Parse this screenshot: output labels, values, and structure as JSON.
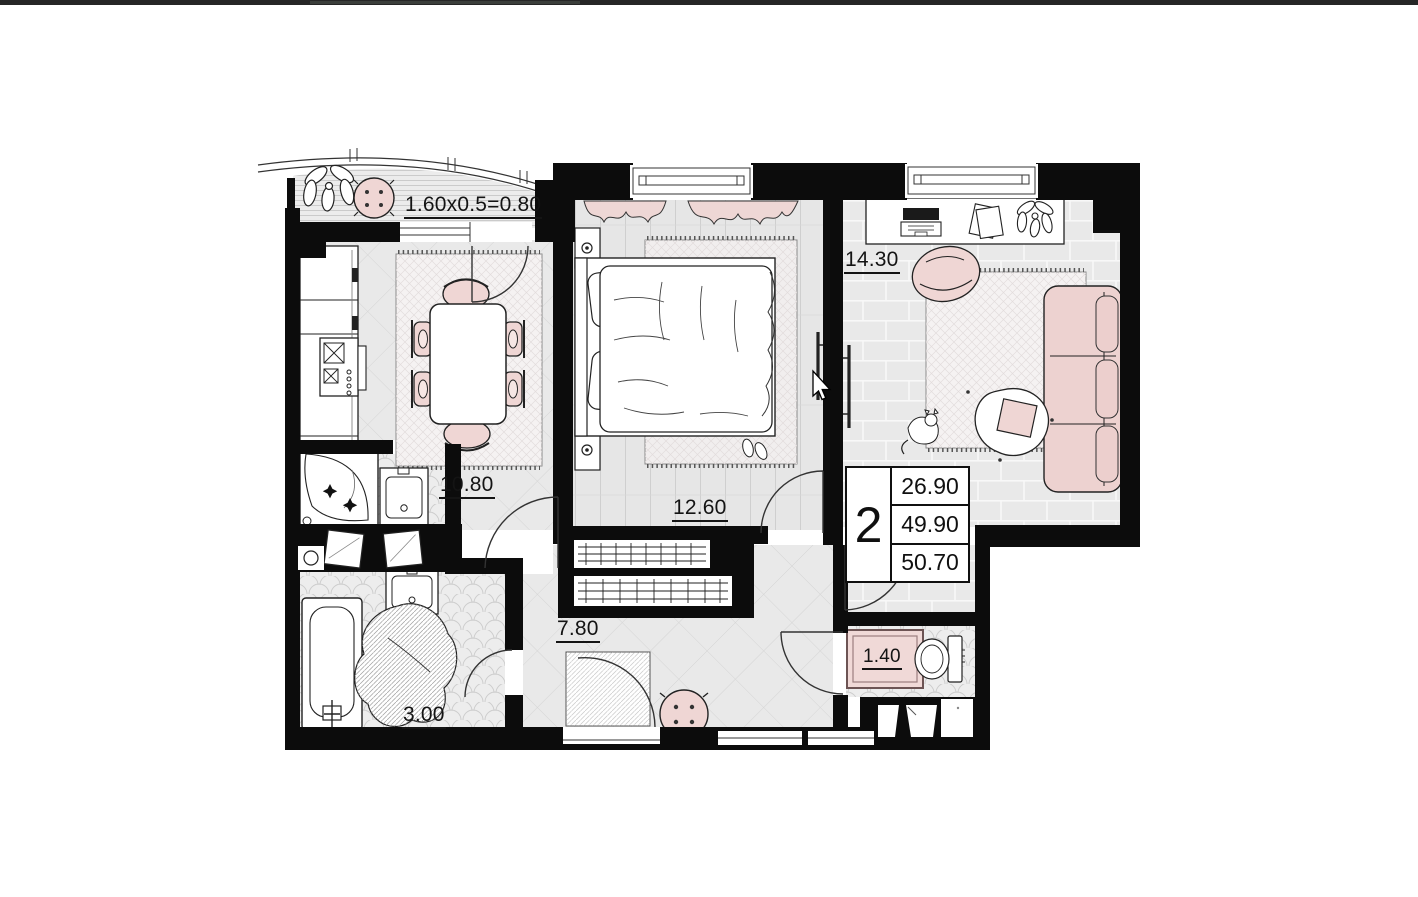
{
  "page": {
    "top_edge_bar_color": "#262626",
    "background": "#ffffff"
  },
  "floor_plan": {
    "balcony": {
      "dimension_label": "1.60x0.5=0.80"
    },
    "kitchen_dining": {
      "area_label": "10.80"
    },
    "bedroom": {
      "area_label": "12.60"
    },
    "living_room": {
      "area_label": "14.30"
    },
    "hallway": {
      "area_label": "7.80"
    },
    "bathroom": {
      "area_label": "3.00"
    },
    "toilet": {
      "area_label": "1.40"
    },
    "summary_table": {
      "room_count": "2",
      "living_area": "26.90",
      "apartment_area": "49.90",
      "total_area": "50.70"
    },
    "colors": {
      "walls": "#0c0c0c",
      "floor_gray": "#e9e9e9",
      "accent_pink": "#efd6d4",
      "outline": "#222222"
    }
  }
}
